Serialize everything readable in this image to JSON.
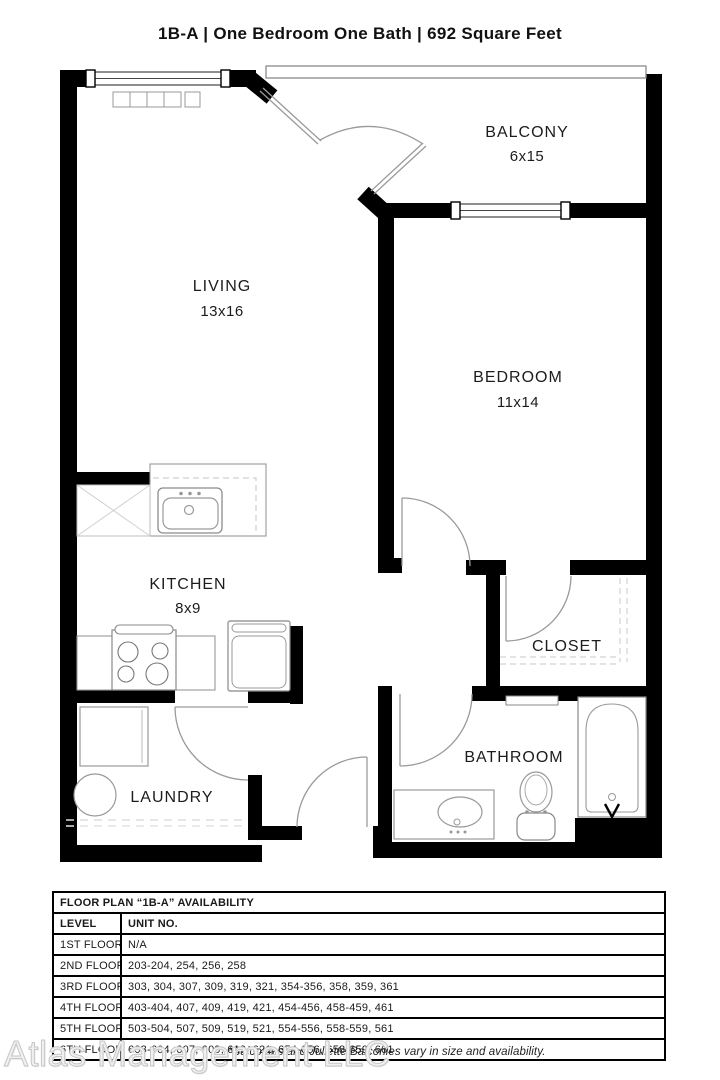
{
  "title": "1B-A  |  One Bedroom One Bath |  692 Square Feet",
  "plan": {
    "rooms": {
      "living": {
        "name": "LIVING",
        "dims": "13x16"
      },
      "balcony": {
        "name": "BALCONY",
        "dims": "6x15"
      },
      "bedroom": {
        "name": "BEDROOM",
        "dims": "11x14"
      },
      "kitchen": {
        "name": "KITCHEN",
        "dims": "8x9"
      },
      "closet": {
        "name": "CLOSET"
      },
      "bathroom": {
        "name": "BATHROOM"
      },
      "laundry": {
        "name": "LAUNDRY"
      }
    }
  },
  "availability_table": {
    "title": "FLOOR PLAN “1B-A” AVAILABILITY",
    "columns": {
      "level": "LEVEL",
      "unit": "UNIT NO."
    },
    "rows": [
      {
        "level": "1ST FLOOR",
        "units": "N/A"
      },
      {
        "level": "2ND FLOOR",
        "units": "203-204, 254, 256, 258"
      },
      {
        "level": "3RD FLOOR",
        "units": "303, 304, 307, 309, 319, 321, 354-356, 358, 359, 361"
      },
      {
        "level": "4TH FLOOR",
        "units": "403-404, 407, 409, 419, 421, 454-456, 458-459, 461"
      },
      {
        "level": "5TH FLOOR",
        "units": "503-504, 507, 509, 519, 521, 554-556, 558-559, 561"
      },
      {
        "level": "6TH FLOOR",
        "units": "603-604, 607, 609, 619, 621, 654-656, 658-659, 661"
      }
    ]
  },
  "watermark": "Atlas Management LLC",
  "footnote": "*Balconies and Juliette Balconies vary in size and availability."
}
